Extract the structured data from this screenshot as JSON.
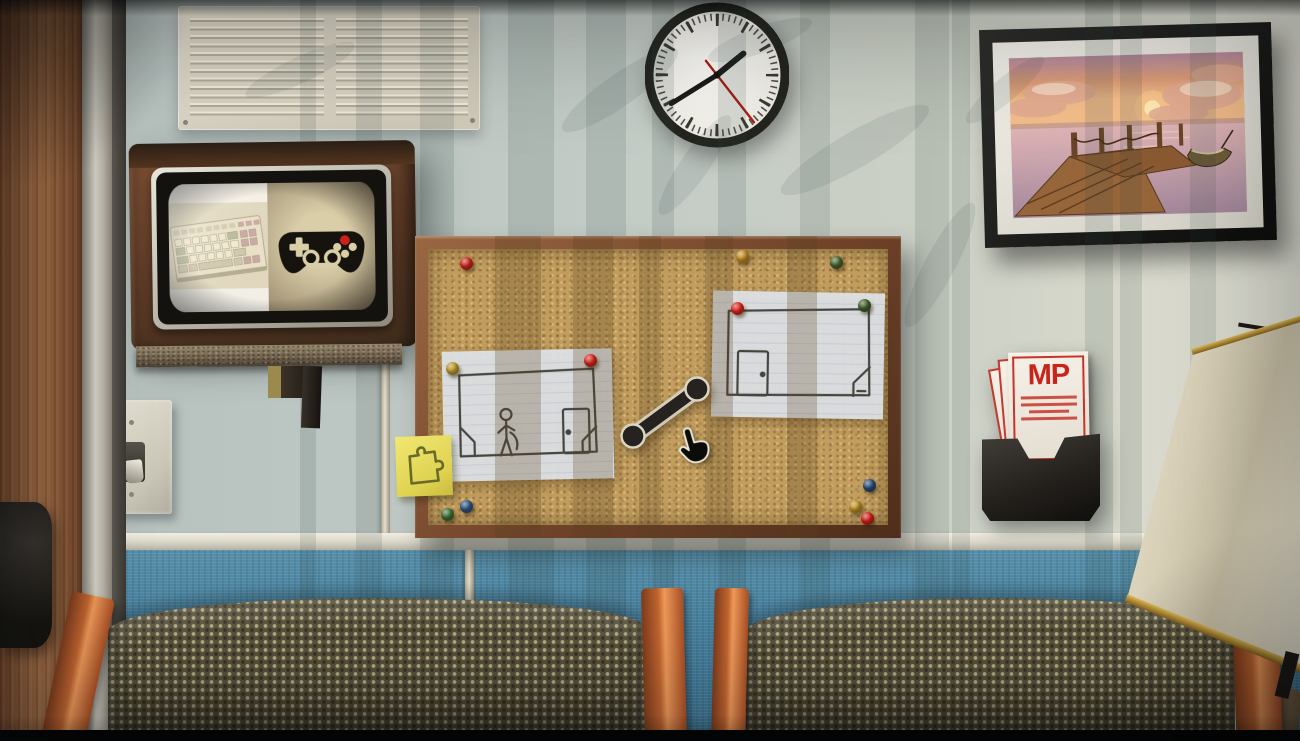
{
  "scene": {
    "objects": [
      "door",
      "air-vent",
      "wall-clock",
      "crt-tv",
      "keyboard-icon",
      "gamepad-icon",
      "framed-picture-sunset-dock",
      "cork-board",
      "room-sketch-note-left",
      "room-sketch-note-right",
      "link-rod",
      "sticky-note-puzzle",
      "hand-cursor",
      "light-switch",
      "brochure-holder",
      "lamp",
      "wall-outlet",
      "waiting-chairs"
    ],
    "colors": {
      "wall_upper": "#c4ccc6",
      "wall_lower": "#47809d",
      "trim": "#eee9dc",
      "cork": "#c29d5d",
      "board_frame": "#6f4229",
      "chair_wood": "#c2652f",
      "chair_fabric": "#57513c",
      "sticky_note": "#e8dd5c",
      "tv_wood": "#6a4430",
      "pamphlet_red": "#c8241c",
      "letterbox": "#040404"
    }
  },
  "clock": {
    "time_shown": "1:40",
    "hour_deg": 51,
    "minute_deg": 238,
    "second_deg": 142
  },
  "tv": {
    "left_option": "keyboard",
    "right_option": "gamepad"
  },
  "brochure": {
    "logo": "MP"
  },
  "corkboard": {
    "pins": [
      {
        "color": "#c8251d",
        "x": 466,
        "y": 263
      },
      {
        "color": "#c08a26",
        "x": 742,
        "y": 256
      },
      {
        "color": "#47622e",
        "x": 836,
        "y": 262
      },
      {
        "color": "#b99428",
        "x": 452,
        "y": 368
      },
      {
        "color": "#d4261c",
        "x": 590,
        "y": 360
      },
      {
        "color": "#d4261c",
        "x": 737,
        "y": 308
      },
      {
        "color": "#3f5e2b",
        "x": 864,
        "y": 305
      },
      {
        "color": "#3f6e35",
        "x": 447,
        "y": 514
      },
      {
        "color": "#2f5380",
        "x": 466,
        "y": 506
      },
      {
        "color": "#2a4a74",
        "x": 869,
        "y": 485
      },
      {
        "color": "#bd8e25",
        "x": 855,
        "y": 506
      },
      {
        "color": "#cc2018",
        "x": 867,
        "y": 518
      }
    ]
  }
}
